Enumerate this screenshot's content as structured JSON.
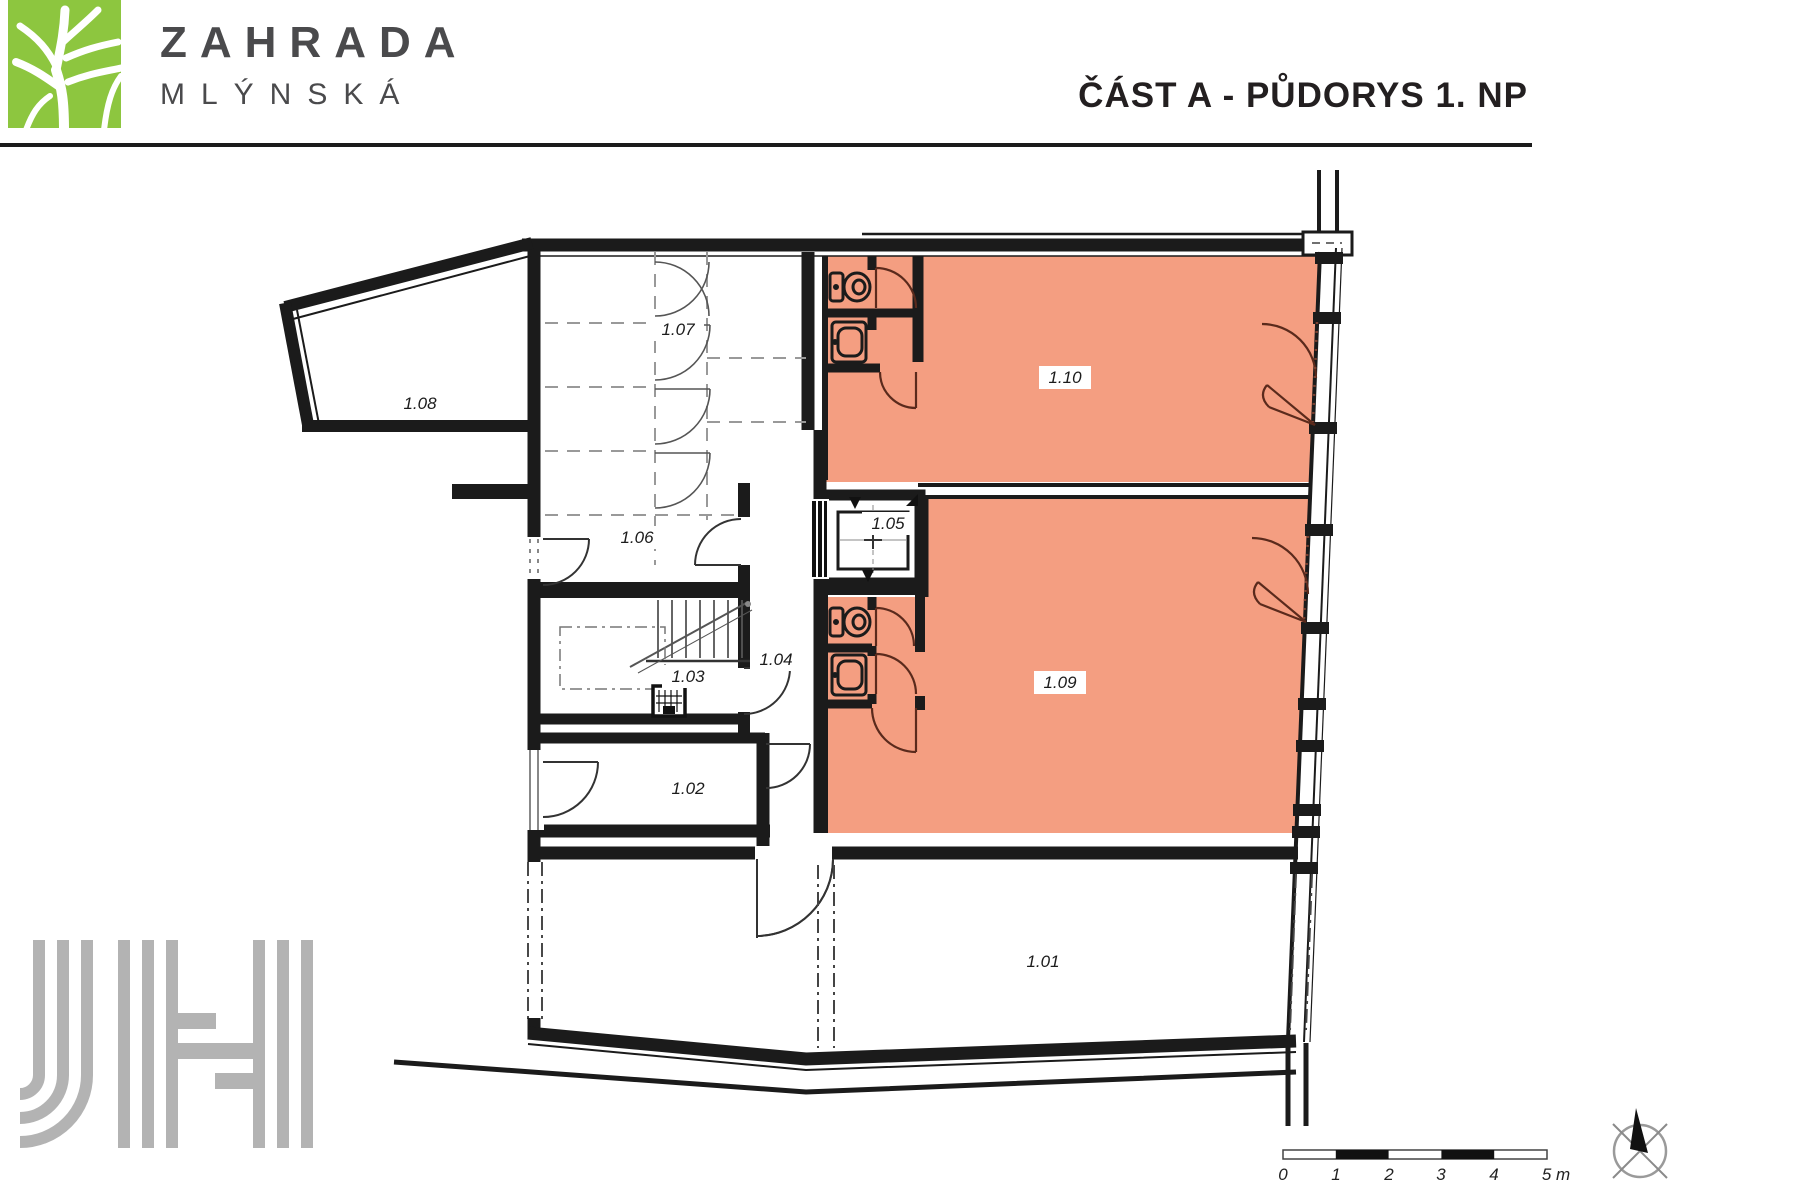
{
  "header": {
    "brand_line1": "ZAHRADA",
    "brand_line2": "MLÝNSKÁ",
    "title": "ČÁST A - PŮDORYS 1. NP"
  },
  "colors": {
    "accent_green": "#8dc63f",
    "room_highlight_fill": "#f49e81",
    "wall_black": "#1b1b1b",
    "logo_gray": "#b3b3b3",
    "door_arc_dark": "#5a2a1c"
  },
  "plan": {
    "rooms": [
      {
        "id": "room-1-01",
        "label": "1.01"
      },
      {
        "id": "room-1-02",
        "label": "1.02"
      },
      {
        "id": "room-1-03",
        "label": "1.03"
      },
      {
        "id": "room-1-04",
        "label": "1.04"
      },
      {
        "id": "room-1-05",
        "label": "1.05"
      },
      {
        "id": "room-1-06",
        "label": "1.06"
      },
      {
        "id": "room-1-07",
        "label": "1.07"
      },
      {
        "id": "room-1-08",
        "label": "1.08"
      },
      {
        "id": "room-1-09",
        "label": "1.09"
      },
      {
        "id": "room-1-10",
        "label": "1.10"
      }
    ]
  },
  "icons": {
    "tree_logo": "tree-icon",
    "toilet": "toilet-icon",
    "sink": "sink-icon",
    "elevator": "elevator-icon",
    "stairs": "stairs-icon",
    "compass": "north-compass-icon"
  },
  "scale_bar": {
    "tick_labels": [
      "0",
      "1",
      "2",
      "3",
      "4"
    ],
    "end_label": "5 m"
  }
}
